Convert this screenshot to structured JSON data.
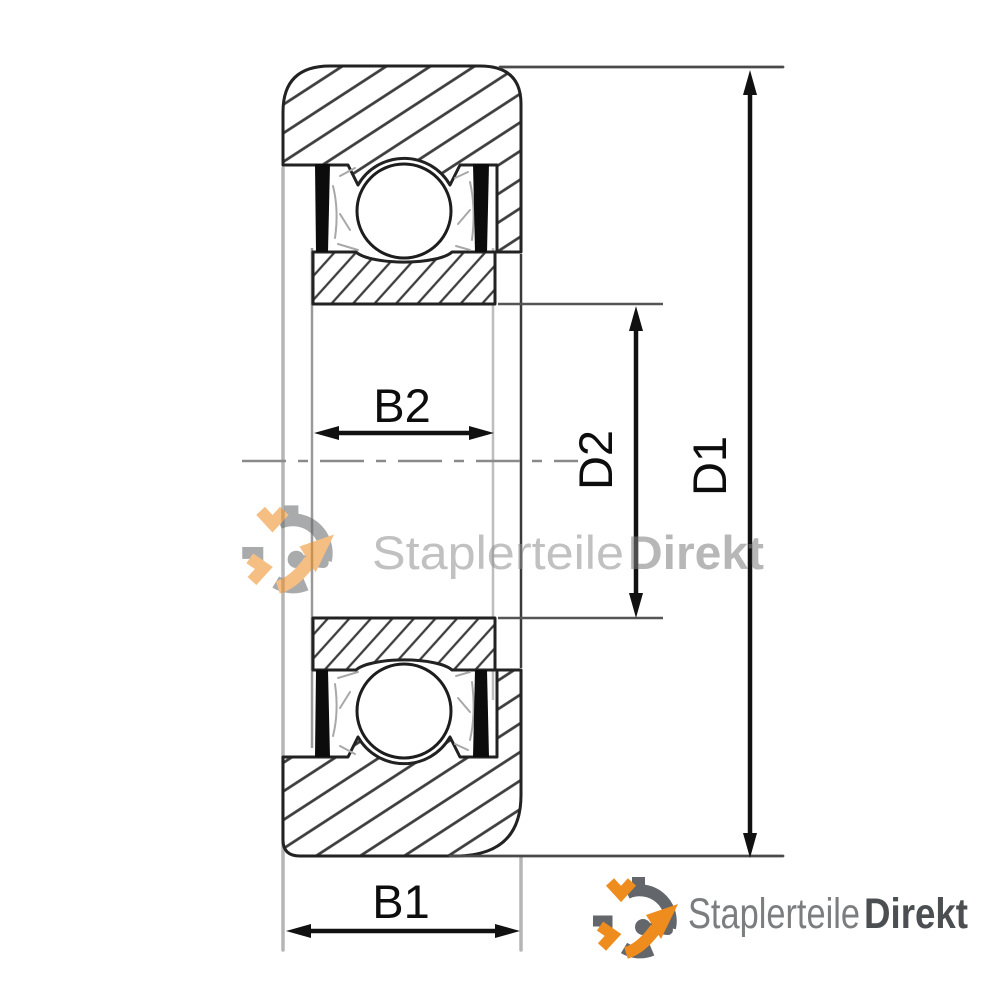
{
  "diagram": {
    "type": "bearing-cross-section-technical-drawing",
    "dimensions": {
      "b1": "B1",
      "b2": "B2",
      "d1": "D1",
      "d2": "D2"
    },
    "colors": {
      "contour": "#222222",
      "hatch": "#3d3d3d",
      "dimension": "#111111",
      "extension_light": "#b5b5b5",
      "seal": "#0c0c0c",
      "background": "#ffffff"
    }
  },
  "watermark": {
    "brand_regular": "Staplerteile",
    "brand_bold": "Direkt",
    "opacity": "0.55",
    "text_color_regular": "#8f8f8f",
    "text_color_bold": "#7e7e7e"
  },
  "logo": {
    "brand_regular": "Staplerteile",
    "brand_bold": "Direkt",
    "icon_orange": "#ee8c1e",
    "icon_gray": "#63666a",
    "text_color_regular": "#7b7d7f",
    "text_color_bold": "#4c4f51"
  }
}
